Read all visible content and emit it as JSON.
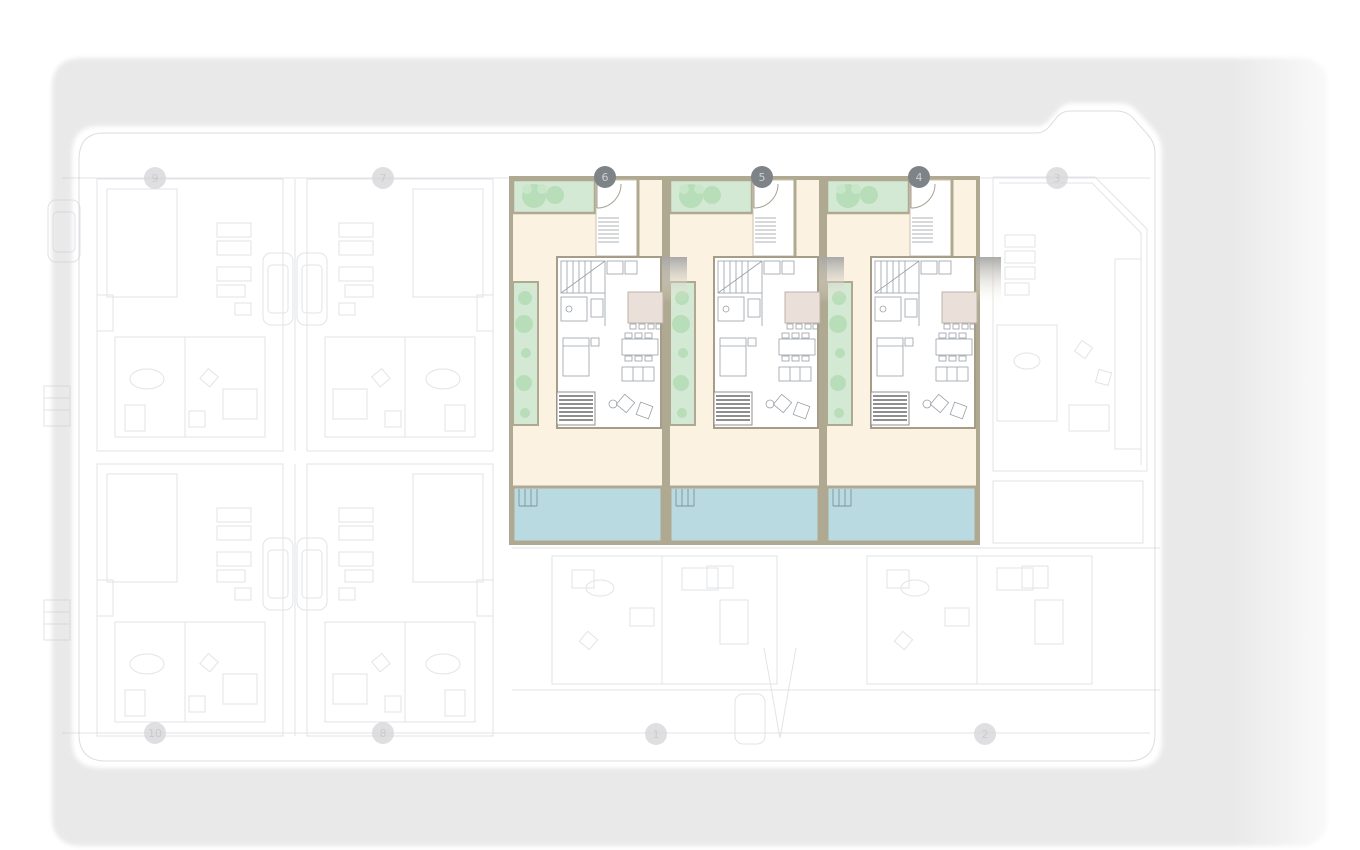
{
  "site_plan": {
    "description": "Residential development site plan with three highlighted townhouse units (garden, house, terrace and pool per unit); surrounding units shown faded",
    "highlighted_units": [
      {
        "number": "6",
        "state": "highlighted"
      },
      {
        "number": "5",
        "state": "highlighted"
      },
      {
        "number": "4",
        "state": "highlighted"
      }
    ],
    "faded_units": [
      {
        "number": "9",
        "state": "faded"
      },
      {
        "number": "7",
        "state": "faded"
      },
      {
        "number": "3",
        "state": "faded"
      },
      {
        "number": "10",
        "state": "faded"
      },
      {
        "number": "8",
        "state": "faded"
      },
      {
        "number": "1",
        "state": "faded"
      },
      {
        "number": "2",
        "state": "faded"
      }
    ],
    "colors": {
      "surround_road": "#e9e9e9",
      "parcel": "#ffffff",
      "floor_cream": "#fbf2e2",
      "garden_green": "#d4e9d4",
      "shrub_green": "#b7ddb9",
      "pool_blue": "#badae2",
      "wall_taupe": "#b0a992",
      "kitchen_beige": "#eadfd9",
      "marker_active_bg": "#7e8388",
      "marker_active_text": "#ccd0d3",
      "marker_inactive_bg": "#d8d8da",
      "faded_linework": "#c7c9cf"
    }
  }
}
